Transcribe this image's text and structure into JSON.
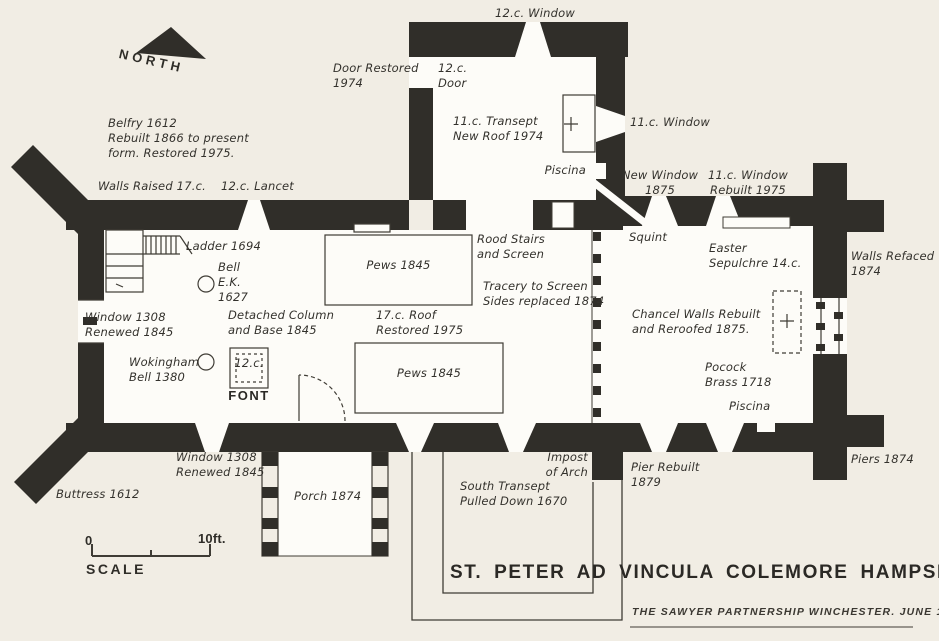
{
  "title": "ST. PETER AD VINCULA COLEMORE HAMPSHIRE",
  "credit": "THE SAWYER PARTNERSHIP WINCHESTER. JUNE 1975",
  "colors": {
    "paper": "#f1ede4",
    "wall": "#302e29",
    "interior": "#fdfcf8",
    "ink": "#33312c"
  },
  "scale": {
    "zero": "0",
    "ten_ft": "10ft.",
    "label": "SCALE"
  },
  "labels": {
    "north": "NORTH",
    "window_12c_top": "12.c. Window",
    "door_restored": "Door Restored\n1974",
    "door_12c": "12.c.\nDoor",
    "transept_11c": "11.c. Transept\nNew Roof 1974",
    "window_11c": "11.c. Window",
    "piscina_north": "Piscina",
    "new_window": "New Window\n1875",
    "window_rebuilt": "11.c. Window\nRebuilt 1975",
    "belfry": "Belfry 1612\nRebuilt 1866 to present\nform. Restored 1975.",
    "walls_raised": "Walls Raised 17.c.",
    "lancet_12c": "12.c. Lancet",
    "ladder": "Ladder 1694",
    "bell_ek": "Bell\nE.K.\n1627",
    "window_1308_west": "Window 1308\nRenewed 1845",
    "detached_column": "Detached Column\nand Base 1845",
    "wokingham": "Wokingham\nBell 1380",
    "font_date": "12.c.",
    "font": "FONT",
    "pews_north": "Pews 1845",
    "roof_17c": "17.c. Roof\nRestored 1975",
    "pews_south": "Pews 1845",
    "rood_stairs": "Rood Stairs\nand Screen",
    "tracery": "Tracery to Screen\nSides replaced 1874",
    "squint": "Squint",
    "easter_sepulchre": "Easter\nSepulchre 14.c.",
    "chancel_walls": "Chancel Walls Rebuilt\nand Reroofed 1875.",
    "pocock": "Pocock\nBrass 1718",
    "piscina_south": "Piscina",
    "walls_refaced": "Walls Refaced\n1874",
    "piers_1874": "Piers 1874",
    "window_1308_south": "Window 1308\nRenewed 1845",
    "buttress": "Buttress 1612",
    "porch": "Porch 1874",
    "impost": "Impost\nof Arch",
    "south_transept": "South Transept\nPulled Down 1670",
    "pier_rebuilt": "Pier Rebuilt\n1879"
  }
}
